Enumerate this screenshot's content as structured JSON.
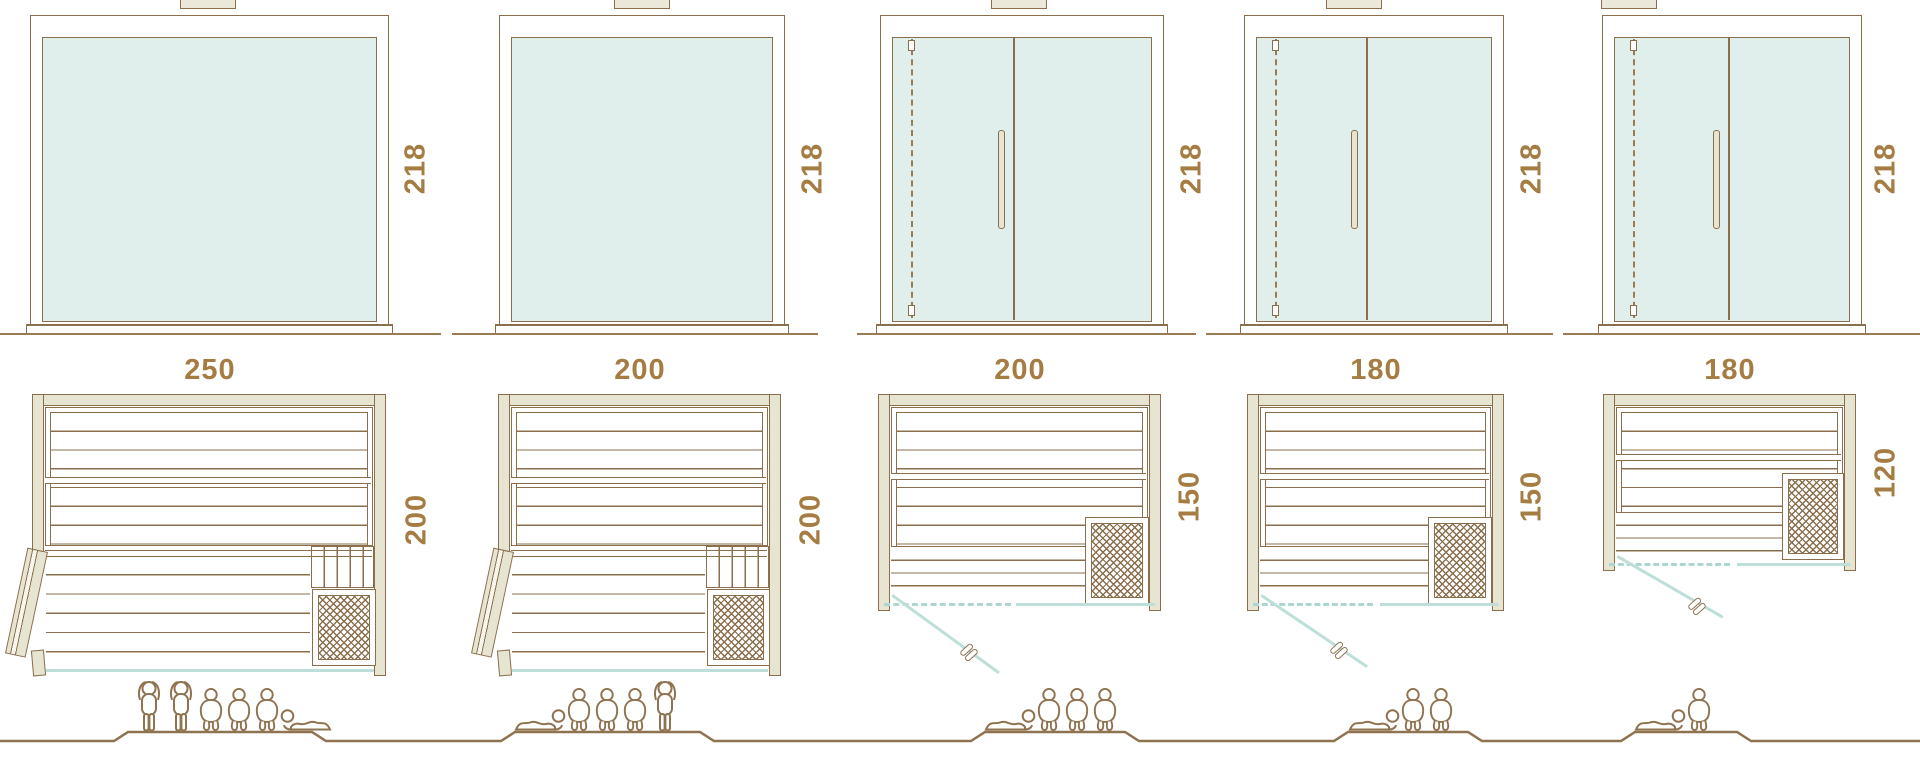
{
  "colors": {
    "outline_brown": "#8b6f4d",
    "label_gold": "#a57c42",
    "glass_fill": "#e0efec",
    "glass_line_teal": "#bedfd9",
    "wood_beige": "#e7e4d2"
  },
  "saunas": [
    {
      "height": "218",
      "width": "250",
      "depth": "200",
      "capacity": [
        "standing",
        "standing",
        "sitting",
        "sitting",
        "sitting",
        "lying_left"
      ]
    },
    {
      "height": "218",
      "width": "200",
      "depth": "200",
      "capacity": [
        "lying",
        "sitting",
        "sitting",
        "sitting",
        "standing"
      ]
    },
    {
      "height": "218",
      "width": "200",
      "depth": "150",
      "capacity": [
        "lying",
        "sitting",
        "sitting",
        "sitting"
      ]
    },
    {
      "height": "218",
      "width": "180",
      "depth": "150",
      "capacity": [
        "lying",
        "sitting",
        "sitting"
      ]
    },
    {
      "height": "218",
      "width": "180",
      "depth": "120",
      "capacity": [
        "lying",
        "sitting"
      ]
    }
  ]
}
